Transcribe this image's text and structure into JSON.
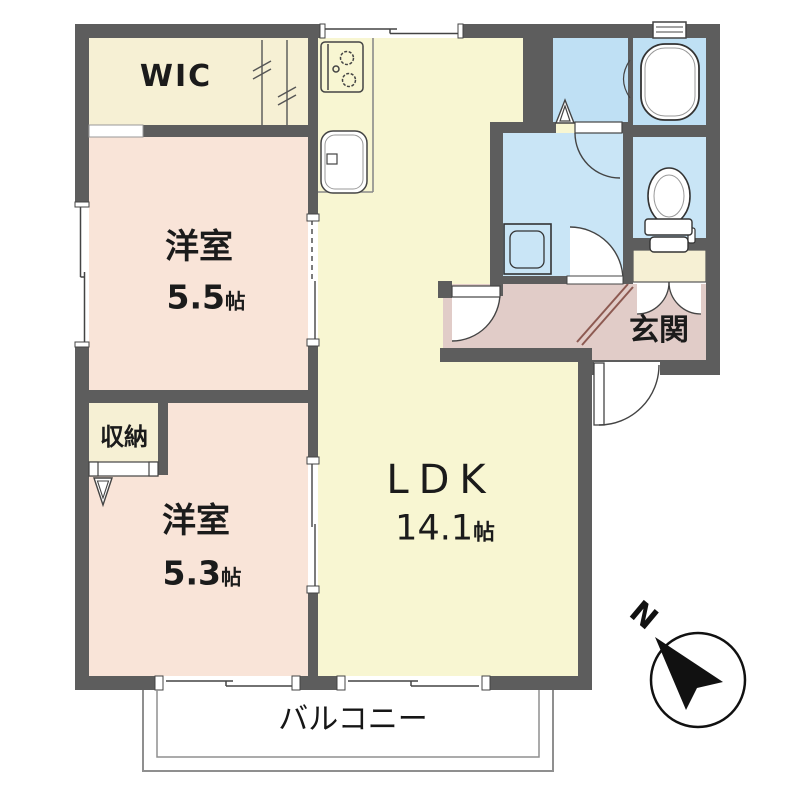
{
  "plan_title": "2LDK apartment floor plan",
  "rooms": {
    "wic": {
      "label": "WIC"
    },
    "bedroom1": {
      "label": "洋室",
      "size": "5.5",
      "unit": "帖"
    },
    "storage": {
      "label": "収納"
    },
    "bedroom2": {
      "label": "洋室",
      "size": "5.3",
      "unit": "帖"
    },
    "ldk": {
      "label": "LDK",
      "size": "14.1",
      "unit": "帖"
    },
    "entrance": {
      "label": "玄関"
    },
    "balcony": {
      "label": "バルコニー"
    }
  },
  "compass": {
    "north_label": "N",
    "direction": "north-up-left"
  },
  "fixtures": [
    "gas-stove-icon",
    "kitchen-sink-icon",
    "bathtub-icon",
    "toilet-icon",
    "washing-machine-icon",
    "shoe-cabinet-icon",
    "compass-north-arrow-icon"
  ],
  "colors": {
    "wall": "#5d5d5d",
    "ldk_floor": "#f8f6d2",
    "bedroom_floor": "#f9e4d8",
    "closet_floor": "#f6f0d4",
    "bathroom_floor": "#bfe0f4",
    "washroom_floor": "#c9e5f6",
    "entrance_floor": "#e1ccc8",
    "line": "#444444"
  }
}
